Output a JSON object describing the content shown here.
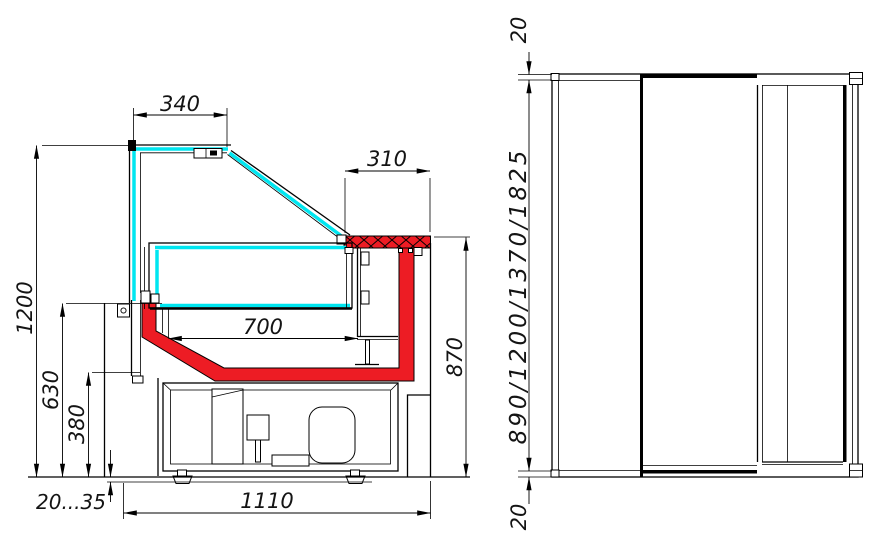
{
  "drawing": {
    "title": "refrigerated-display-case-technical-drawing",
    "dimensions": {
      "canopy_depth": "340",
      "counter_depth": "310",
      "well_width": "700",
      "overall_height": "1200",
      "sill_height": "630",
      "base_height": "380",
      "foot_adjust": "20...35",
      "overall_depth": "1110",
      "counter_height": "870",
      "front_top_offset": "20",
      "front_bottom_offset": "20",
      "available_lengths": "890/1200/1370/1825"
    },
    "colors": {
      "glass": "#00e6f0",
      "panel": "#ed1c24",
      "line": "#000000",
      "background": "#ffffff"
    }
  }
}
